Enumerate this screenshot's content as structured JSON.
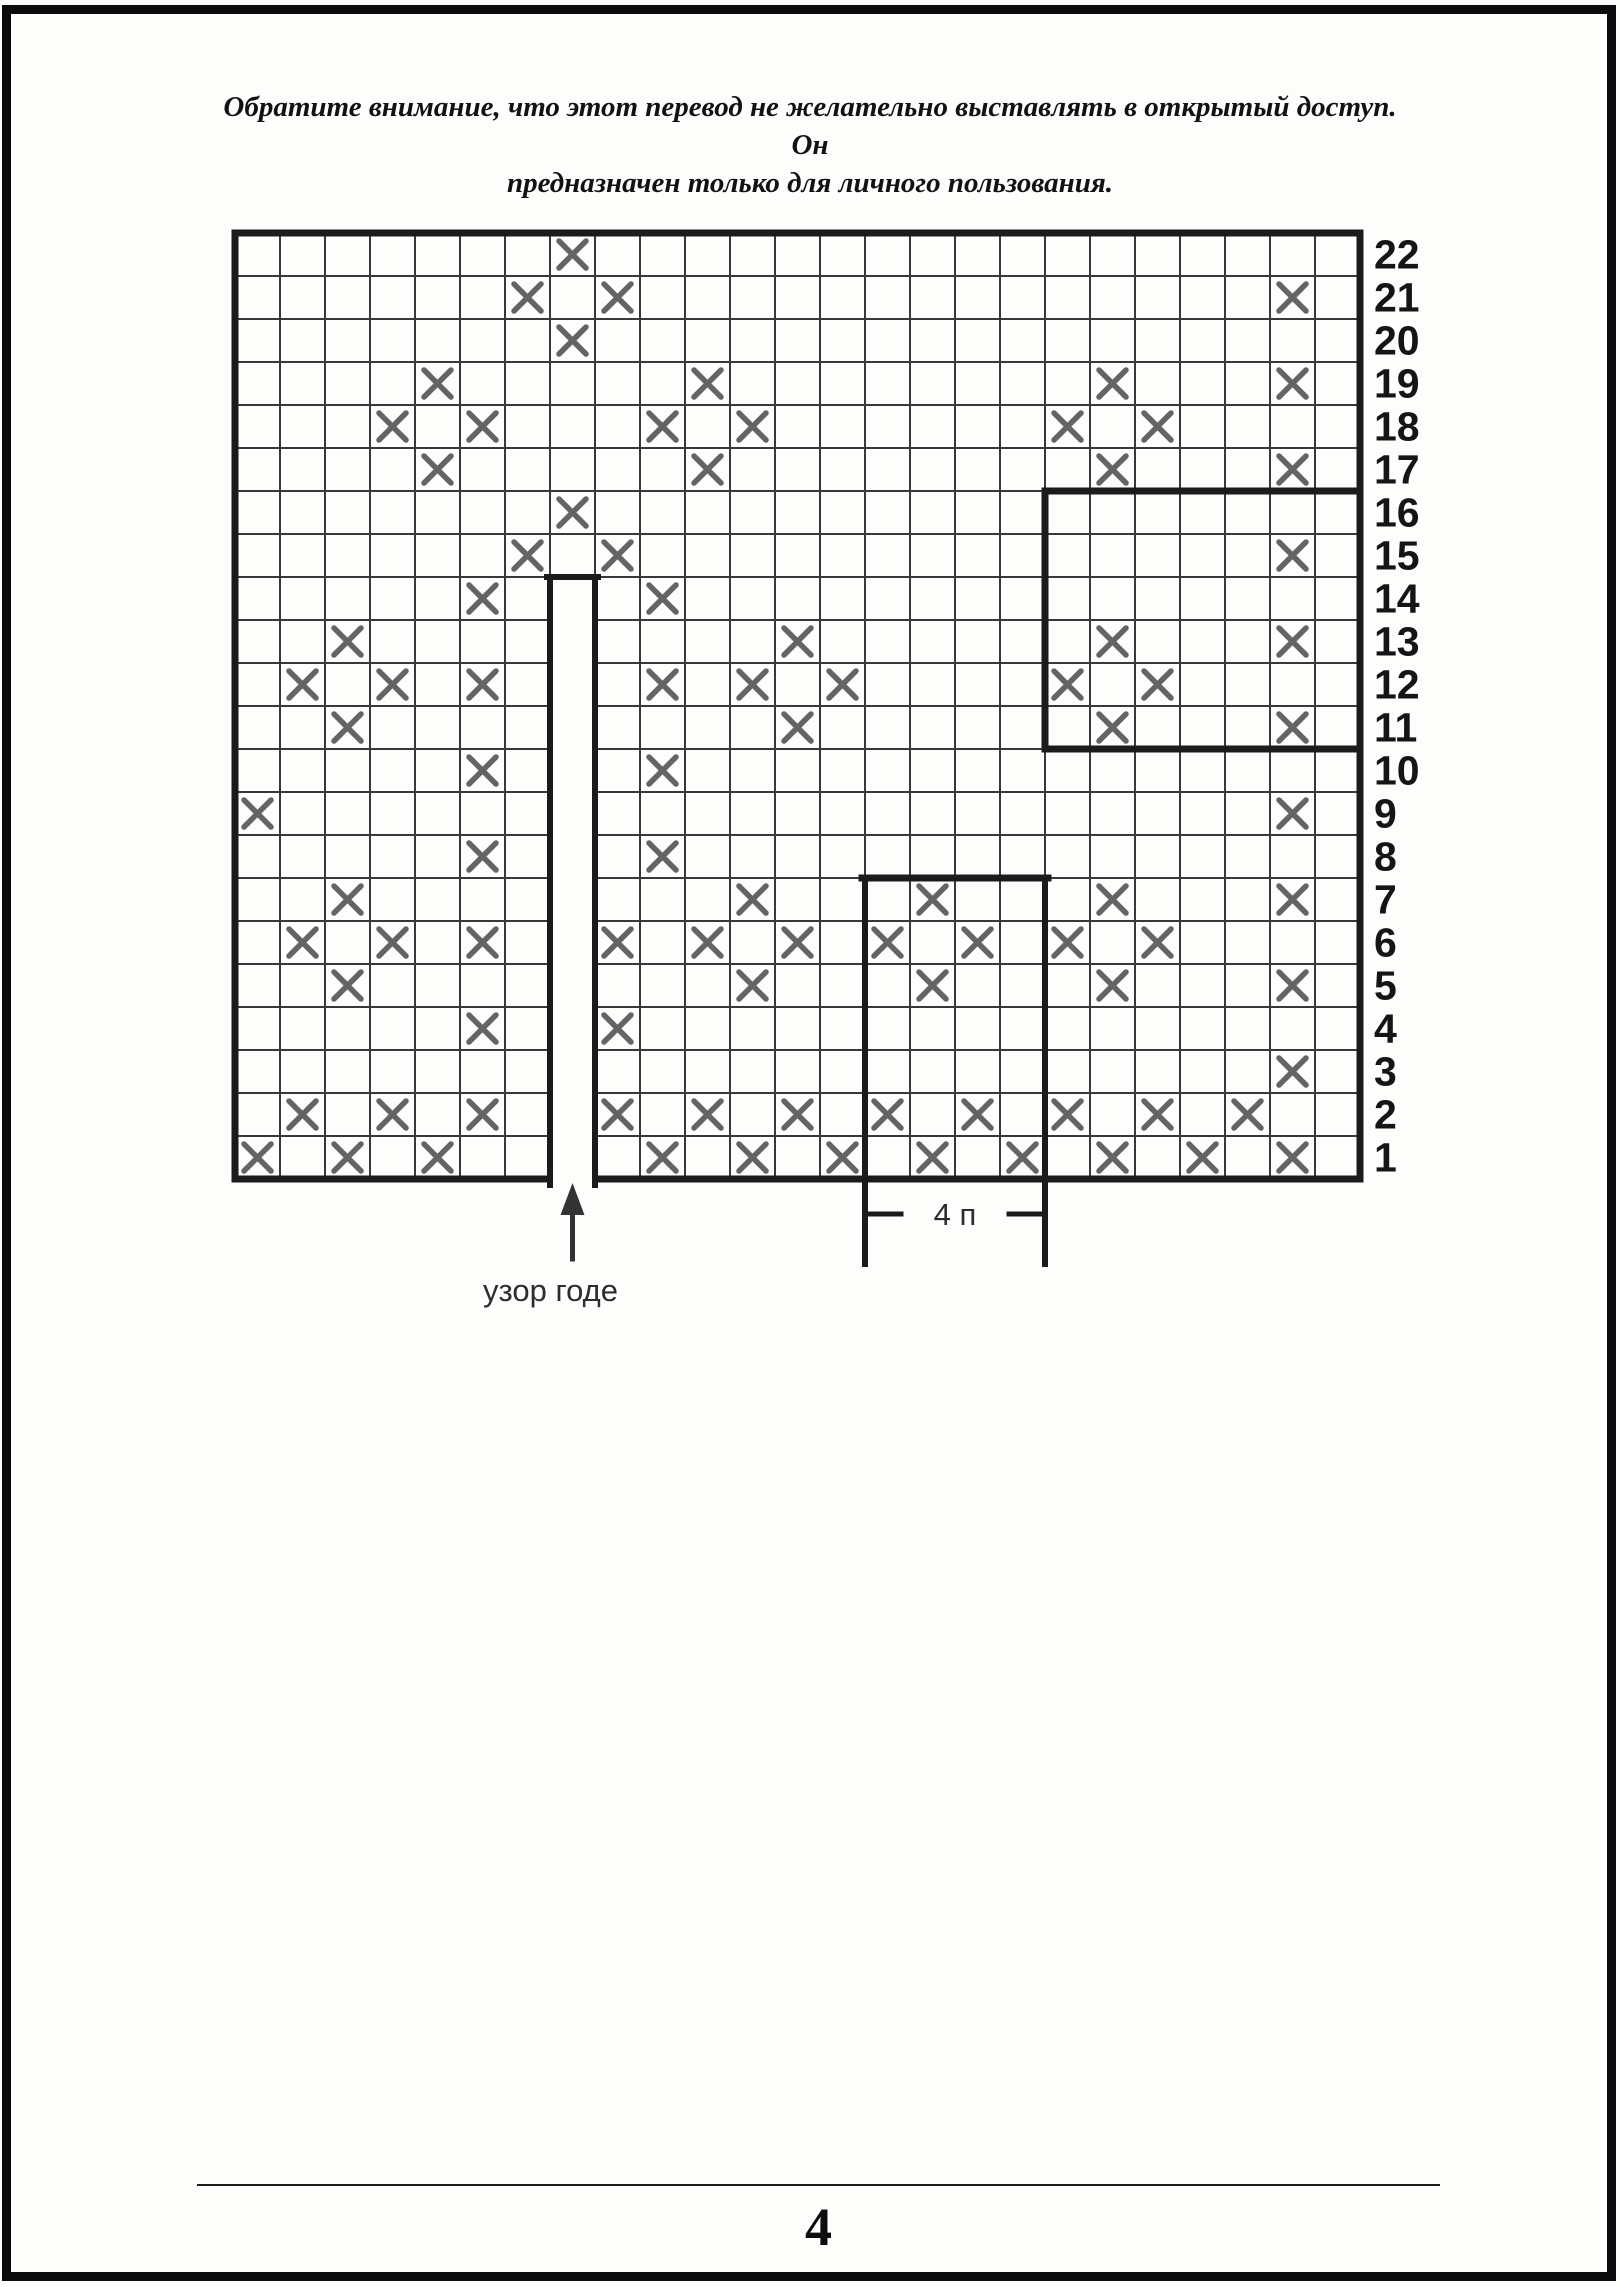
{
  "header": {
    "line1": "Обратите внимание, что этот перевод не желательно выставлять в открытый доступ. Он",
    "line2": "предназначен только для личного пользования."
  },
  "diagram": {
    "type": "knitting-chart",
    "columns": 25,
    "rows": 22,
    "mark_symbol": "X",
    "row_labels": [
      "22",
      "21",
      "20",
      "19",
      "18",
      "17",
      "16",
      "15",
      "14",
      "13",
      "12",
      "11",
      "10",
      "9",
      "8",
      "7",
      "6",
      "5",
      "4",
      "3",
      "2",
      "1"
    ],
    "marks_by_row": {
      "22": [
        8
      ],
      "21": [
        7,
        9,
        24
      ],
      "20": [
        8
      ],
      "19": [
        5,
        11,
        20,
        24
      ],
      "18": [
        4,
        6,
        10,
        12,
        19,
        21
      ],
      "17": [
        5,
        11,
        20,
        24
      ],
      "16": [
        8
      ],
      "15": [
        7,
        9,
        24
      ],
      "14": [
        6,
        10
      ],
      "13": [
        3,
        13,
        20,
        24
      ],
      "12": [
        2,
        4,
        6,
        10,
        12,
        14,
        19,
        21
      ],
      "11": [
        3,
        13,
        20,
        24
      ],
      "10": [
        6,
        10
      ],
      "9": [
        1,
        24
      ],
      "8": [
        6,
        10
      ],
      "7": [
        3,
        12,
        16,
        20,
        24
      ],
      "6": [
        2,
        4,
        6,
        9,
        11,
        13,
        15,
        17,
        19,
        21
      ],
      "5": [
        3,
        12,
        16,
        20,
        24
      ],
      "4": [
        6,
        9
      ],
      "3": [
        24
      ],
      "2": [
        2,
        4,
        6,
        9,
        11,
        13,
        15,
        17,
        19,
        21,
        23
      ],
      "1": [
        1,
        3,
        5,
        10,
        12,
        14,
        16,
        18,
        20,
        22,
        24
      ]
    },
    "slit": {
      "column": 8,
      "top_row": 14,
      "bottom_row": 1
    },
    "right_inner_rect": {
      "row_from": 11,
      "row_to": 16,
      "col_from": 19,
      "col_to": 25
    },
    "bottom_inner_rect": {
      "row_from": 1,
      "row_to": 7,
      "col_from": 15,
      "col_to": 18
    },
    "labels": {
      "gore": "узор годе",
      "stitch_count": "4 п"
    },
    "colors": {
      "grid_line": "#383838",
      "bold_line": "#1b1b1b",
      "mark": "#646464",
      "label_text": "#151515",
      "annotation_text": "#2d2d2d"
    }
  },
  "footer": {
    "page_number": "4"
  }
}
